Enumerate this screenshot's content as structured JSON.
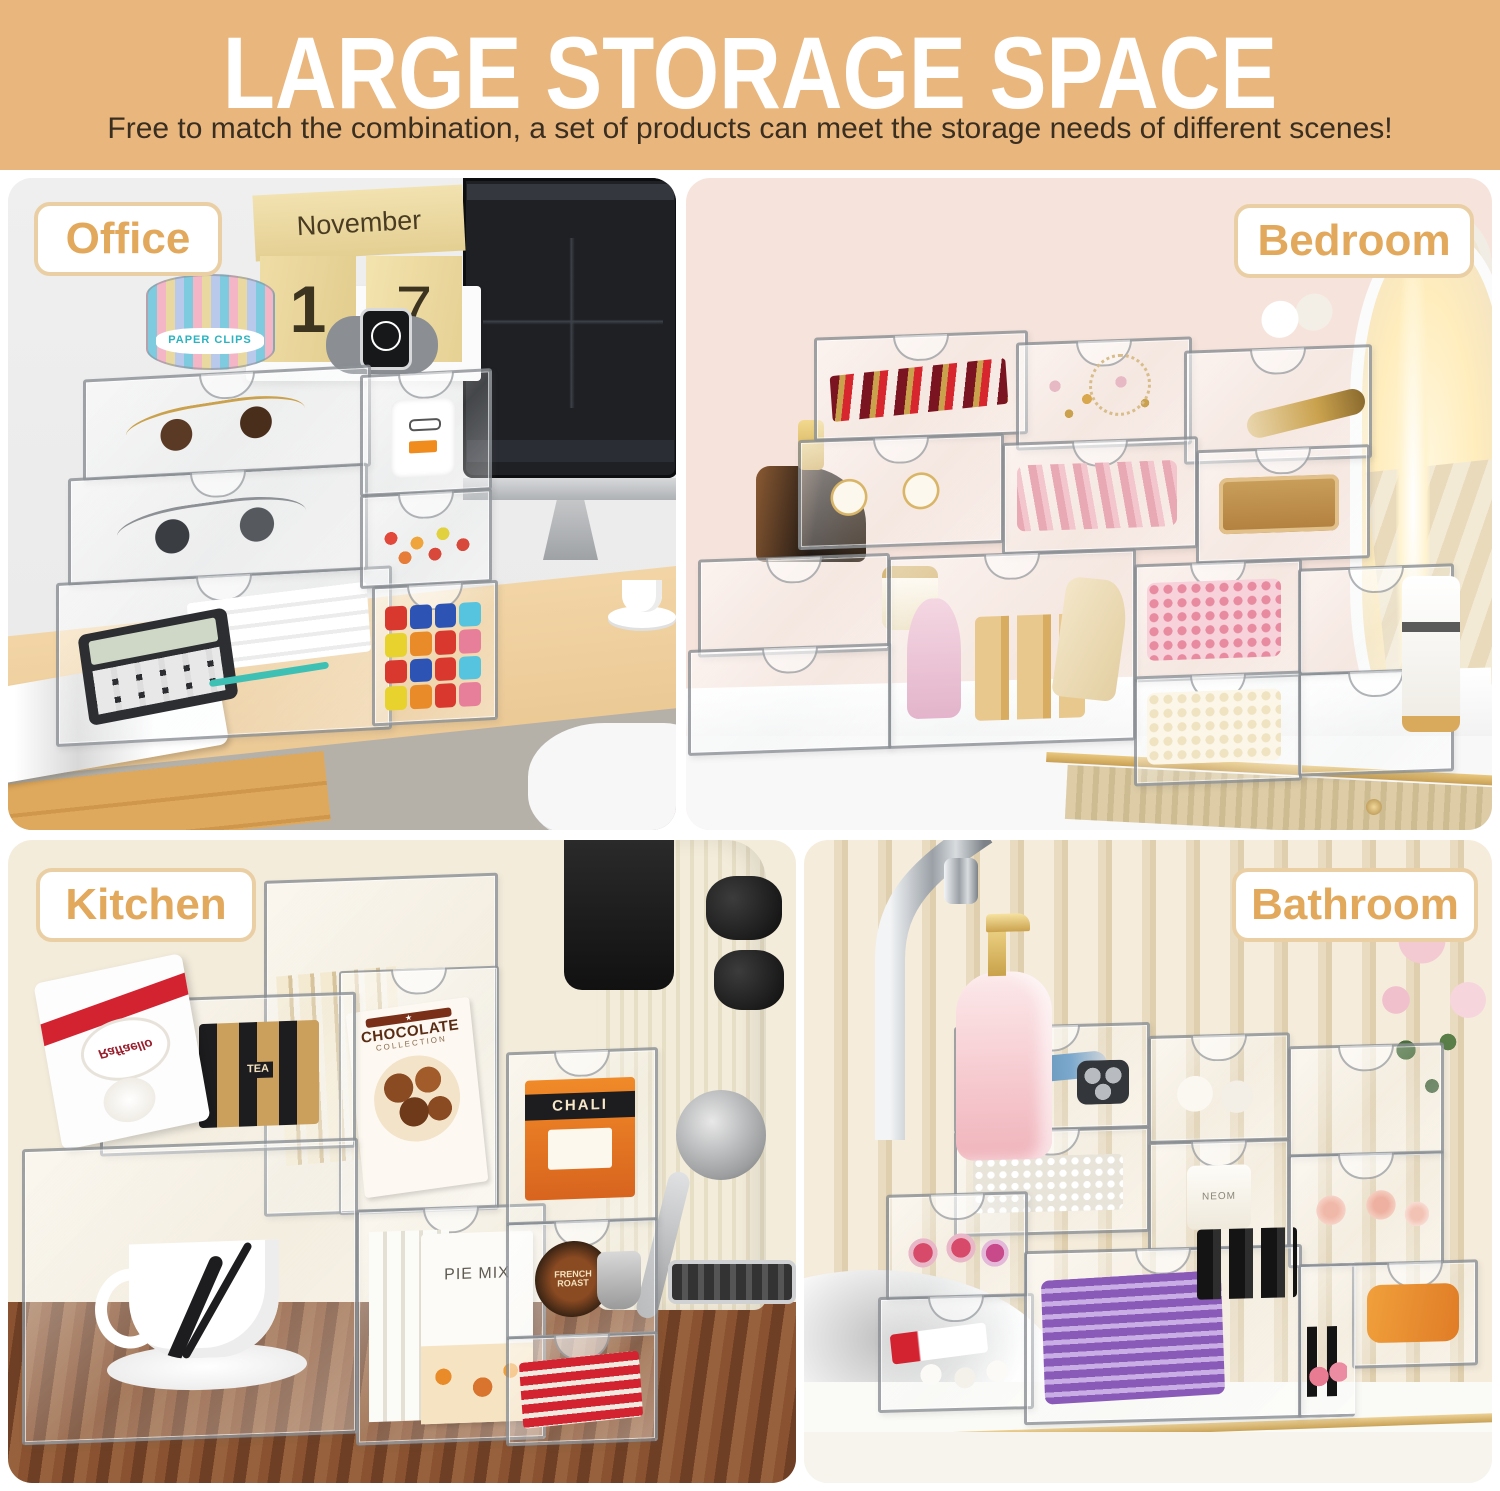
{
  "header": {
    "title": "LARGE STORAGE SPACE",
    "subtitle": "Free to match the combination, a set of products can meet the storage needs of different scenes!"
  },
  "colors": {
    "header_bg": "#E9B77E",
    "title_text": "#FFFFFF",
    "subtitle_text": "#3A2E20",
    "scene_label_text": "#E2A85C",
    "scene_label_border": "#EACFA4",
    "office_wall": "#EDEDED",
    "office_desk_wood": "#EDC795",
    "bedroom_wall": "#F6E4DC",
    "kitchen_wall": "#F4ECDB",
    "kitchen_counter_wood": "#7C4A2C",
    "bathroom_wall_stripe": "#E9DBC0",
    "acrylic_frame": "#7D8288",
    "vanity_gold_trim": "#D9B06A"
  },
  "scenes": {
    "office": {
      "label": "Office",
      "calendar_month": "November",
      "calendar_day_left": "1",
      "calendar_day_right": "7",
      "paper_clips_label": "PAPER CLIPS",
      "items": [
        "wood-block-calendar",
        "apple-watch",
        "paper-clip-holder",
        "sunglasses-brown",
        "sunglasses-black",
        "usb-charger",
        "hair-ties",
        "calculator",
        "marker-caps",
        "desktop-monitor",
        "magazine",
        "coffee-cup",
        "desk-chair"
      ]
    },
    "bedroom": {
      "label": "Bedroom",
      "items": [
        "lipsticks",
        "earrings",
        "necklace",
        "cream-jars",
        "perfume-bottle",
        "makeup-brushes",
        "blush-palette",
        "pink-pearls",
        "white-pearls",
        "nail-polish-gold",
        "makeup-pouch",
        "pink-perfume",
        "skincare-bottle",
        "led-mirror",
        "vanity-desk"
      ]
    },
    "kitchen": {
      "label": "Kitchen",
      "product_labels": {
        "raffaello": "Raffaello",
        "tea_bag": "TEA",
        "chocolate": "CHOCOLATE",
        "chocolate_sub": "COLLECTION",
        "chali": "CHALI",
        "pie_mix": "PIE MIX",
        "french_roast": "FRENCH ROAST"
      },
      "items": [
        "raffaello-box",
        "tea-sachets",
        "kraft-tea-bags",
        "chocolate-box",
        "chali-tea-box",
        "pie-mix-boxes",
        "coffee-pods",
        "red-tea-packets",
        "teacup-saucer",
        "espresso-machine",
        "walnut-counter"
      ]
    },
    "bathroom": {
      "label": "Bathroom",
      "candle_label": "NEOM",
      "items": [
        "chrome-faucet",
        "vessel-sink",
        "soap-dispenser",
        "razor",
        "electric-shaver-head",
        "cotton-pads",
        "cotton-swabs",
        "scented-candle",
        "rolled-towels",
        "face-mask-sheets",
        "nail-polish-black",
        "nail-polish-pink",
        "toothpaste-tubes",
        "roses",
        "gold-trim-counter"
      ]
    }
  }
}
